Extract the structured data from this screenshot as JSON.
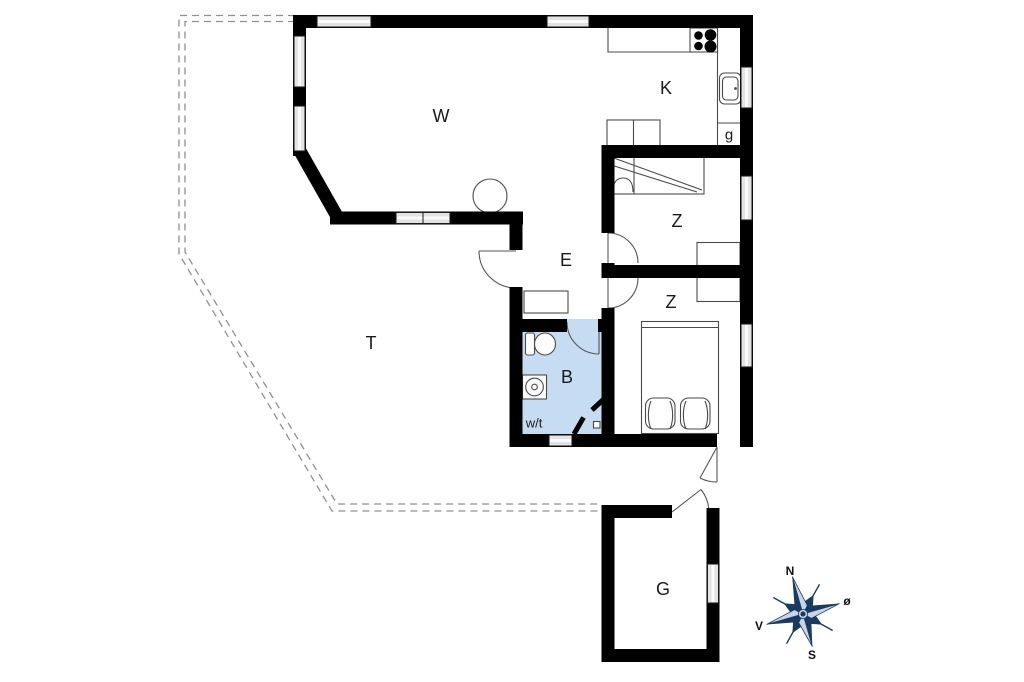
{
  "rooms": {
    "living": "W",
    "kitchen": "K",
    "kitchen_closet": "g",
    "bedroom_top": "Z",
    "bedroom_bottom": "Z",
    "hall": "E",
    "bathroom": "B",
    "washer_dryer": "w/t",
    "terrace": "T",
    "annex": "G"
  },
  "compass": {
    "north": "N",
    "east": "ø",
    "south": "S",
    "west": "V"
  },
  "colors": {
    "wall": "#000000",
    "bathroom_fill": "#c6dcf3",
    "compass_navy": "#1b3a5f",
    "compass_light": "#c9d4e6",
    "dashed": "#909090"
  }
}
